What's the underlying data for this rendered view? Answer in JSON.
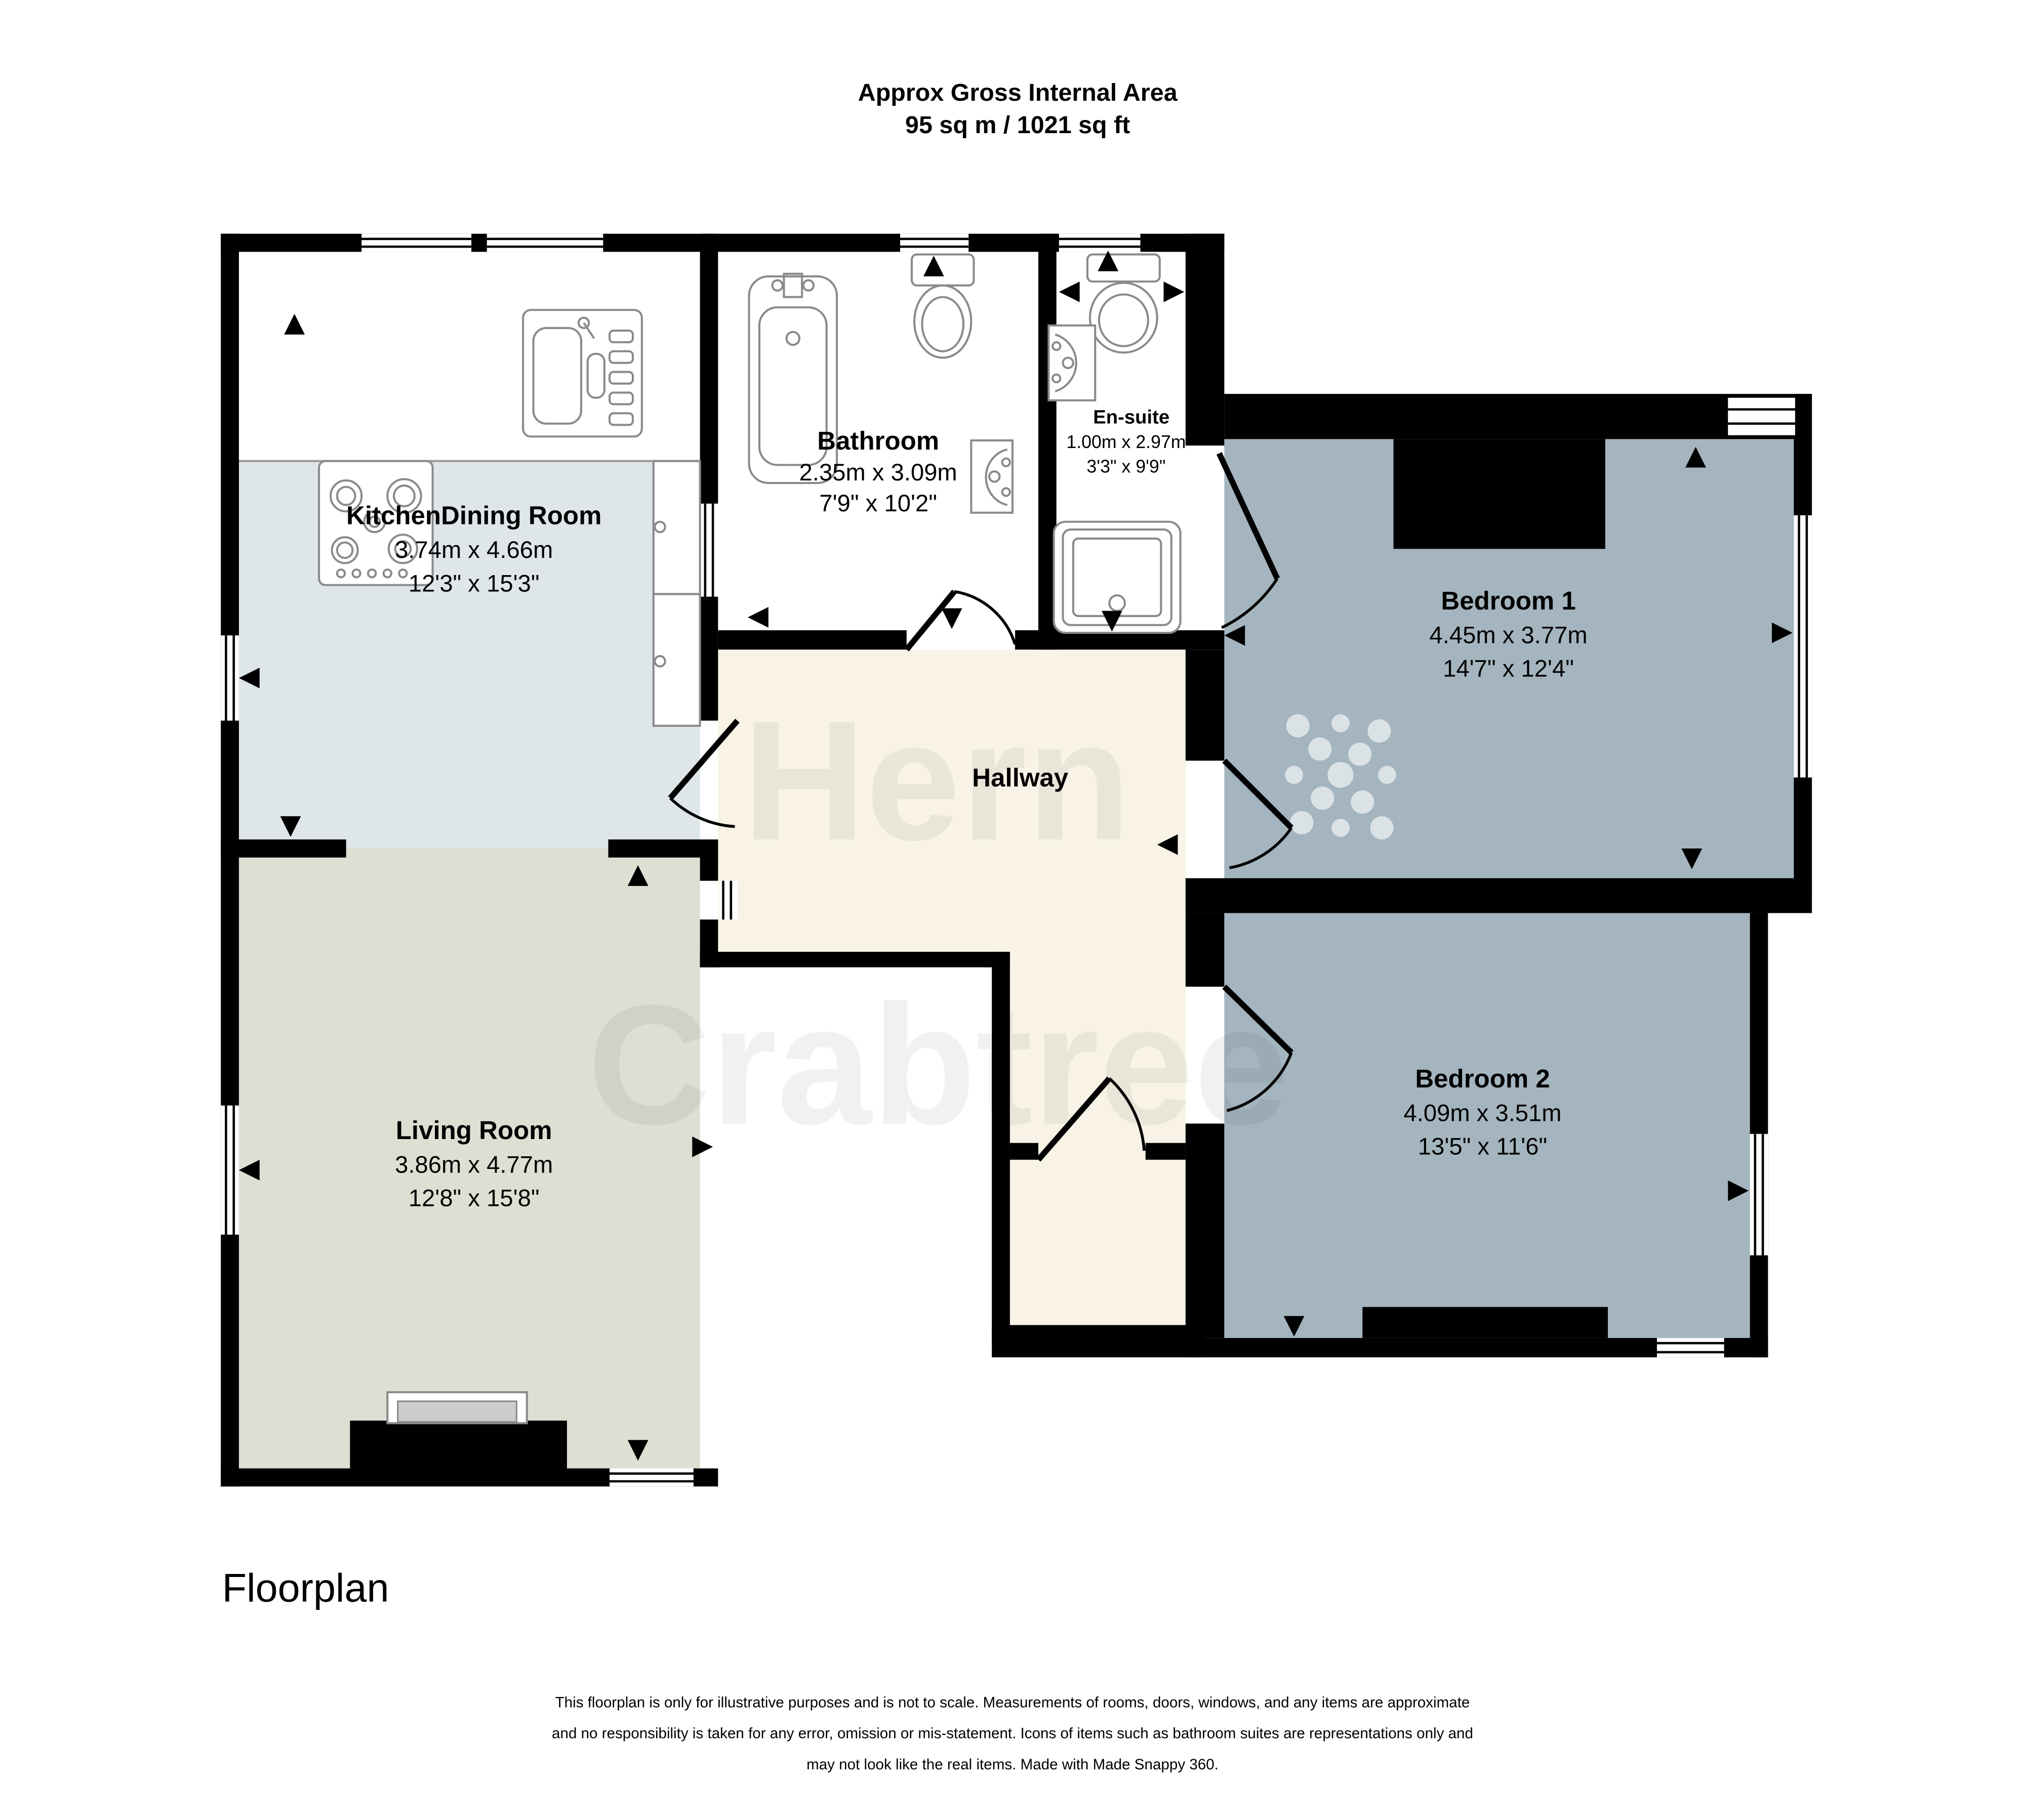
{
  "header": {
    "line1": "Approx Gross Internal Area",
    "line2": "95 sq m / 1021 sq ft"
  },
  "rooms": {
    "kitchen": {
      "name": "KitchenDining Room",
      "metric": "3.74m x 4.66m",
      "imperial": "12'3\" x 15'3\""
    },
    "living": {
      "name": "Living Room",
      "metric": "3.86m x 4.77m",
      "imperial": "12'8\" x 15'8\""
    },
    "bathroom": {
      "name": "Bathroom",
      "metric": "2.35m x 3.09m",
      "imperial": "7'9\" x 10'2\""
    },
    "ensuite": {
      "name": "En-suite",
      "metric": "1.00m x 2.97m",
      "imperial": "3'3\" x 9'9\""
    },
    "bedroom1": {
      "name": "Bedroom 1",
      "metric": "4.45m x 3.77m",
      "imperial": "14'7\" x 12'4\""
    },
    "bedroom2": {
      "name": "Bedroom 2",
      "metric": "4.09m x 3.51m",
      "imperial": "13'5\" x 11'6\""
    },
    "hallway": {
      "name": "Hallway"
    }
  },
  "watermark": {
    "line1": "Hern",
    "line2": "Crabtree"
  },
  "footer": {
    "label": "Floorplan",
    "disclaimer1": "This floorplan is only for illustrative purposes and is not to scale. Measurements of rooms, doors, windows, and any items are approximate",
    "disclaimer2": "and no responsibility is taken for any error, omission or mis-statement. Icons of items such as bathroom suites are representations only and",
    "disclaimer3": "may not look like the real items. Made with Made Snappy 360."
  },
  "colors": {
    "wall": "#000000",
    "kitchen_floor": "#dfe6ea",
    "living_floor": "#dcdfd1",
    "bedroom_floor": "#a5b5bf",
    "hallway_floor": "#f8f3e6",
    "fixture_stroke": "#8a8a8a"
  }
}
